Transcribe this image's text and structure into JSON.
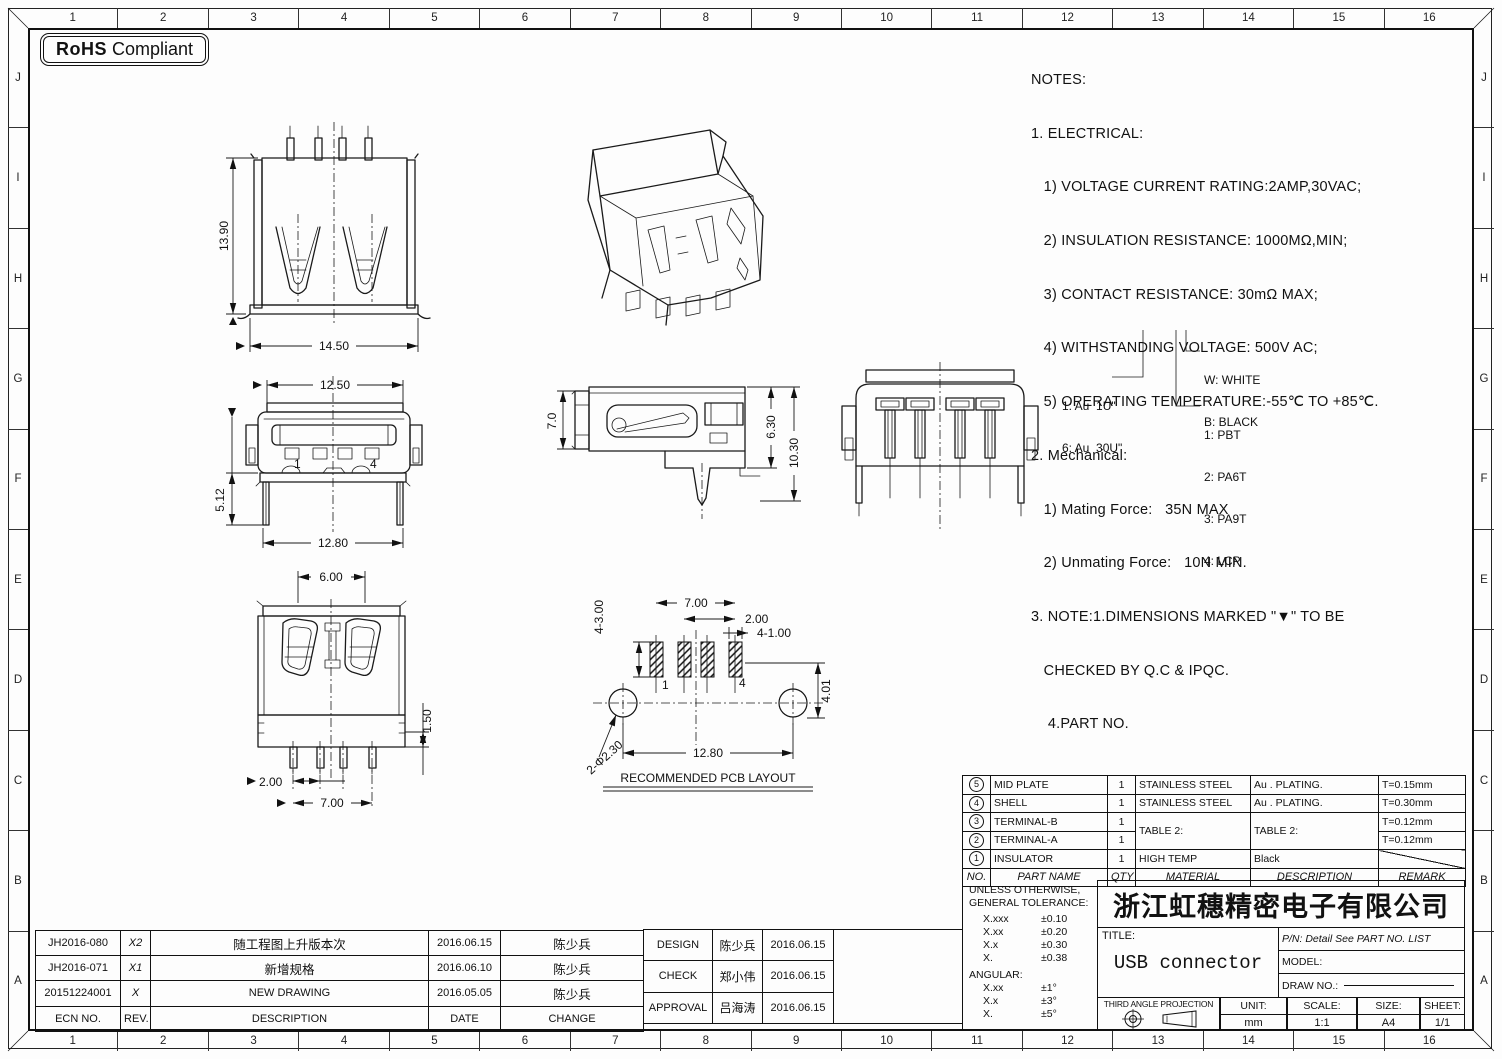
{
  "rohs": {
    "bold": "RoHS",
    "rest": "Compliant"
  },
  "border": {
    "cols": [
      "1",
      "2",
      "3",
      "4",
      "5",
      "6",
      "7",
      "8",
      "9",
      "10",
      "11",
      "12",
      "13",
      "14",
      "15",
      "16"
    ],
    "rows": [
      "J",
      "I",
      "H",
      "G",
      "F",
      "E",
      "D",
      "C",
      "B",
      "A"
    ]
  },
  "notes": {
    "lines": [
      "NOTES:",
      "1. ELECTRICAL:",
      "   1) VOLTAGE CURRENT RATING:2AMP,30VAC;",
      "   2) INSULATION RESISTANCE: 1000MΩ,MIN;",
      "   3) CONTACT RESISTANCE: 30mΩ MAX;",
      "   4) WITHSTANDING VOLTAGE: 500V AC;",
      "   5) OPERATING TEMPERATURE:-55℃ TO +85℃.",
      "2. Mechanical:",
      "   1) Mating Force:   35N MAX",
      "   2) Unmating Force:   10N MIN.",
      "3. NOTE:1.DIMENSIONS MARKED \"▼\" TO BE",
      "   CHECKED BY Q.C & IPQC.",
      "    4.PART NO."
    ]
  },
  "legend": {
    "plating1": "1: Au  1U\"",
    "plating2": "6: Au  30U\"",
    "color1": "W: WHITE",
    "color2": "B: BLACK",
    "mat1": "1: PBT",
    "mat2": "2: PA6T",
    "mat3": "3: PA9T",
    "mat4": "4: LCP"
  },
  "views": {
    "back": {
      "height": "13.90",
      "width": "14.50"
    },
    "front": {
      "top": "12.50",
      "left": "5.12",
      "bottom": "12.80",
      "pin1": "1",
      "pin4": "4"
    },
    "side": {
      "left": "7.0",
      "inner": "6.30",
      "outer": "10.30"
    },
    "top": {
      "width": "6.00",
      "right": "1.50",
      "pitch": "2.00",
      "span": "7.00"
    },
    "pcb": {
      "title": "RECOMMENDED PCB LAYOUT",
      "pad_len": "4-3.00",
      "span": "7.00",
      "pitch": "2.00",
      "pad_w": "4-1.00",
      "width": "12.80",
      "offset": "4.01",
      "holes": "2-Φ2.30",
      "pin1": "1",
      "pin4": "4"
    }
  },
  "parts_table": {
    "headers": [
      "NO.",
      "PART NAME",
      "QTY",
      "MATERIAL",
      "DESCRIPTION",
      "REMARK"
    ],
    "rows": [
      {
        "no": "5",
        "name": "MID PLATE",
        "qty": "1",
        "material": "STAINLESS STEEL",
        "description": "Au . PLATING.",
        "remark": "T=0.15mm"
      },
      {
        "no": "4",
        "name": "SHELL",
        "qty": "1",
        "material": "STAINLESS STEEL",
        "description": "Au . PLATING.",
        "remark": "T=0.30mm"
      },
      {
        "no": "3",
        "name": "TERMINAL-B",
        "qty": "1",
        "material": "TABLE 2:",
        "description": "TABLE 2:",
        "remark": "T=0.12mm"
      },
      {
        "no": "2",
        "name": "TERMINAL-A",
        "qty": "1",
        "remark": "T=0.12mm"
      },
      {
        "no": "1",
        "name": "INSULATOR",
        "qty": "1",
        "material": "HIGH TEMP",
        "description": "Black",
        "remark": ""
      }
    ]
  },
  "tolerance": {
    "line1": "UNLESS OTHERWISE,",
    "line2": "GENERAL TOLERANCE:",
    "rows": [
      [
        "X.xxx",
        "±0.10"
      ],
      [
        "X.xx",
        "±0.20"
      ],
      [
        "X.x",
        "±0.30"
      ],
      [
        "X.",
        "±0.38"
      ]
    ],
    "angular_label": "ANGULAR:",
    "angular_rows": [
      [
        "X.xx",
        "±1°"
      ],
      [
        "X.x",
        "±3°"
      ],
      [
        "X.",
        "±5°"
      ]
    ]
  },
  "title_block": {
    "company": "浙江虹穗精密电子有限公司",
    "title_label": "TITLE:",
    "title": "USB connector",
    "pn": "P/N: Detail See PART NO. LIST",
    "model_label": "MODEL:",
    "draw_label": "DRAW NO.:",
    "projection": "THIRD ANGLE PROJECTION",
    "unit_label": "UNIT:",
    "unit": "mm",
    "scale_label": "SCALE:",
    "scale": "1:1",
    "size_label": "SIZE:",
    "size": "A4",
    "sheet_label": "SHEET:",
    "sheet": "1/1"
  },
  "revision_table": {
    "headers": [
      "ECN NO.",
      "REV.",
      "DESCRIPTION",
      "DATE",
      "CHANGE"
    ],
    "rows": [
      [
        "JH2016-080",
        "X2",
        "随工程图上升版本次",
        "2016.06.15",
        "陈少兵"
      ],
      [
        "JH2016-071",
        "X1",
        "新增规格",
        "2016.06.10",
        "陈少兵"
      ],
      [
        "20151224001",
        "X",
        "NEW DRAWING",
        "2016.05.05",
        "陈少兵"
      ]
    ]
  },
  "approval_table": {
    "rows": [
      [
        "DESIGN",
        "陈少兵",
        "2016.06.15"
      ],
      [
        "CHECK",
        "郑小伟",
        "2016.06.15"
      ],
      [
        "APPROVAL",
        "吕海涛",
        "2016.06.15"
      ]
    ]
  }
}
